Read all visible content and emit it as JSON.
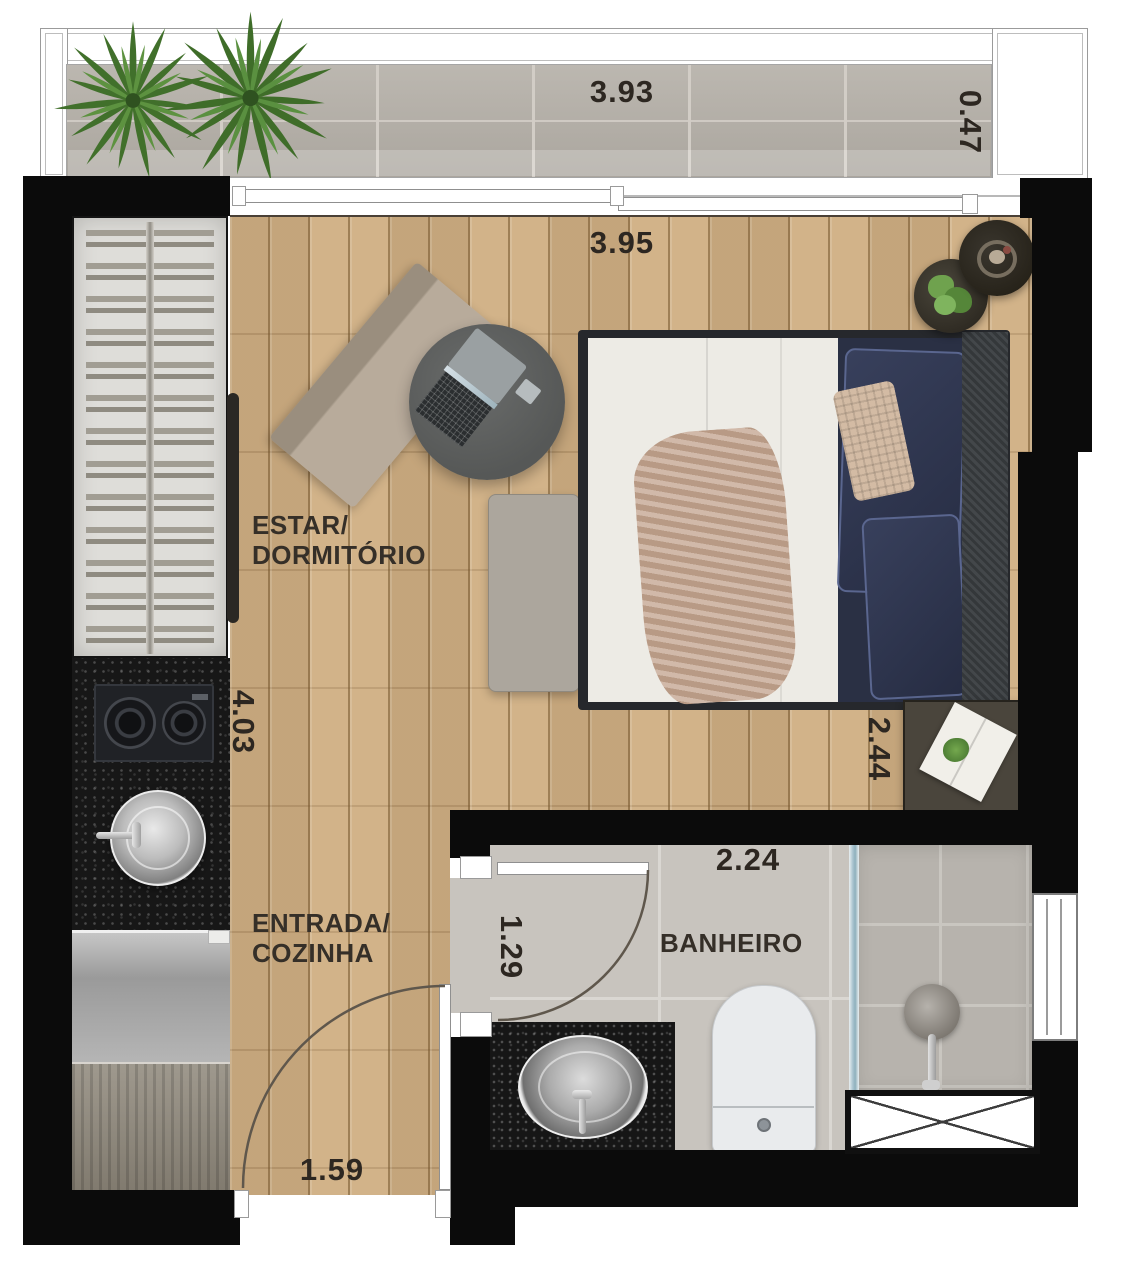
{
  "plan_title": "Studio apartment floor plan",
  "balcony": {
    "width_label": "3.93",
    "depth_label": "0.47"
  },
  "living": {
    "width_label": "3.95",
    "height_label": "4.03",
    "label_line1": "ESTAR/",
    "label_line2": "DORMITÓRIO",
    "side_table_label": "2.44"
  },
  "entry": {
    "label_line1": "ENTRADA/",
    "label_line2": "COZINHA",
    "door_width_label": "1.59"
  },
  "bathroom": {
    "label": "BANHEIRO",
    "width_label": "2.24",
    "depth_label": "1.29"
  },
  "colors": {
    "wall": "#0b0b0b",
    "wood_floor": "#cfae82",
    "balcony_tile": "#b4afa7",
    "bathroom_tile": "#c8c4be",
    "shower_tile": "#b7b3ad",
    "dimension_text": "#2d2721",
    "plant_green": "#4d7c33",
    "navy_pillow": "#2e3550",
    "granite_counter": "#171717",
    "glass_partition": "#9fc0cc"
  },
  "icons": {
    "palm-plant-icon": "radial leaf burst",
    "hanger-rack-icon": "paired horizontal bars on rod",
    "cooktop-icon": "two burner rings",
    "kitchen-sink-icon": "round steel basin with faucet",
    "bathroom-sink-icon": "oval steel basin with faucet",
    "toilet-icon": "rounded bowl with flush button",
    "shower-head-icon": "circle head with arm",
    "door-swing-icon": "quarter-circle arc",
    "window-icon": "double-line frame",
    "laptop-icon": "open laptop top view",
    "shaft-icon": "crossed white box",
    "bed-icon": "double bed top view"
  }
}
